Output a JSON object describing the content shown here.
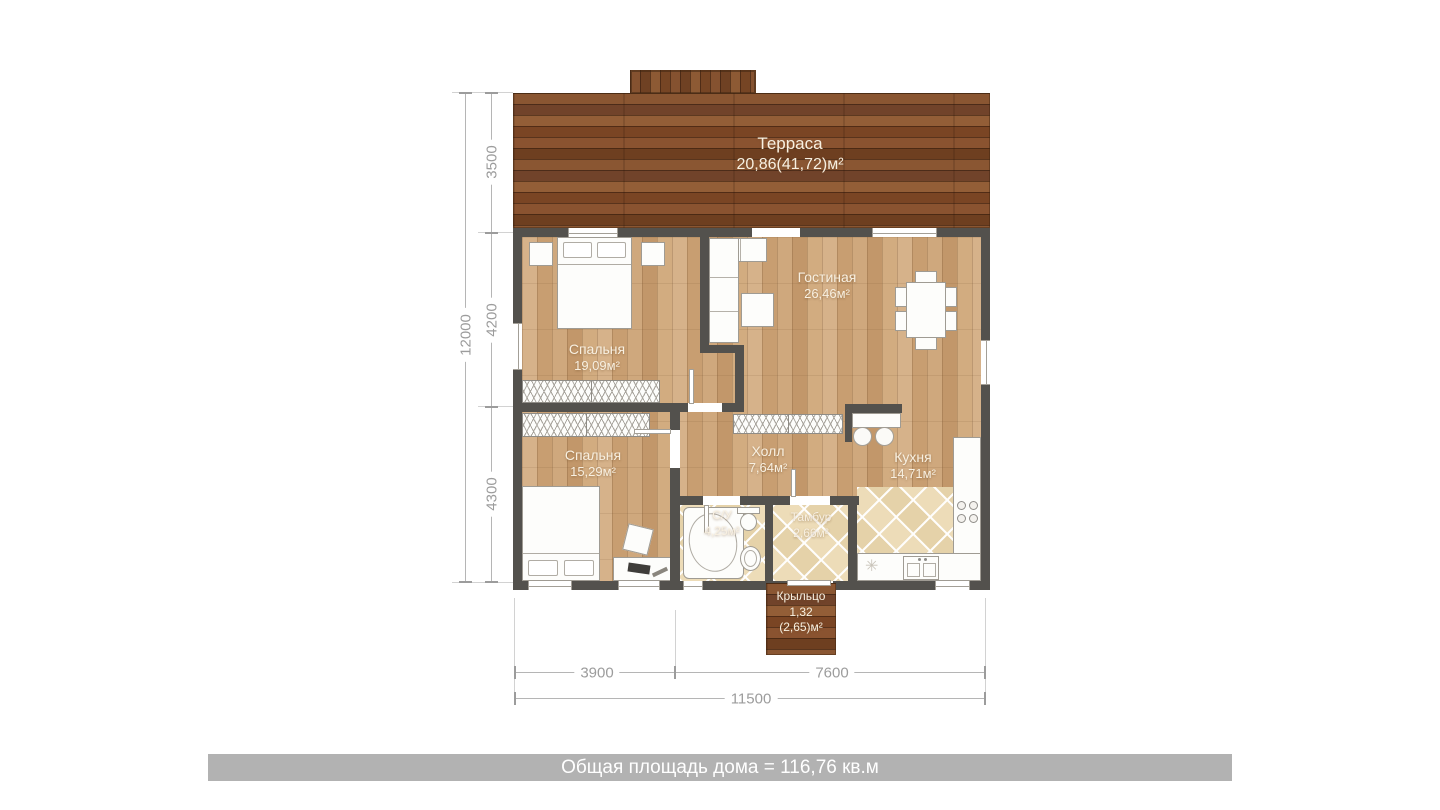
{
  "summary_bar": {
    "text": "Общая площадь дома = 116,76 кв.м"
  },
  "rooms": {
    "terrace": {
      "name": "Терраса",
      "area": "20,86(41,72)м²"
    },
    "living": {
      "name": "Гостиная",
      "area": "26,46м²"
    },
    "bedroom1": {
      "name": "Спальня",
      "area": "19,09м²"
    },
    "bedroom2": {
      "name": "Спальня",
      "area": "15,29м²"
    },
    "hall": {
      "name": "Холл",
      "area": "7,64м²"
    },
    "kitchen": {
      "name": "Кухня",
      "area": "14,71м²"
    },
    "bathroom": {
      "name": "С/У",
      "area": "4,25м²"
    },
    "vestibule": {
      "name": "Тамбур",
      "area": "2,66м²"
    },
    "porch": {
      "name": "Крыльцо",
      "area": "1,32",
      "area_gross": "(2,65)м²"
    }
  },
  "dimensions": {
    "left": {
      "total": "12000",
      "segments": [
        "3500",
        "4200",
        "4300"
      ]
    },
    "bottom": {
      "segments": [
        "3900",
        "7600"
      ],
      "total": "11500"
    }
  },
  "symbols": {
    "appliance": "✳"
  },
  "colors": {
    "wall": "#53514d",
    "terrace_wood": "#7f4d2a",
    "floor_wood": "#cba379",
    "tile": "#ecdcba",
    "banner_bg": "#b2b2b2",
    "dimension_text": "#9c9c9c",
    "room_label": "#f8f0e1"
  }
}
